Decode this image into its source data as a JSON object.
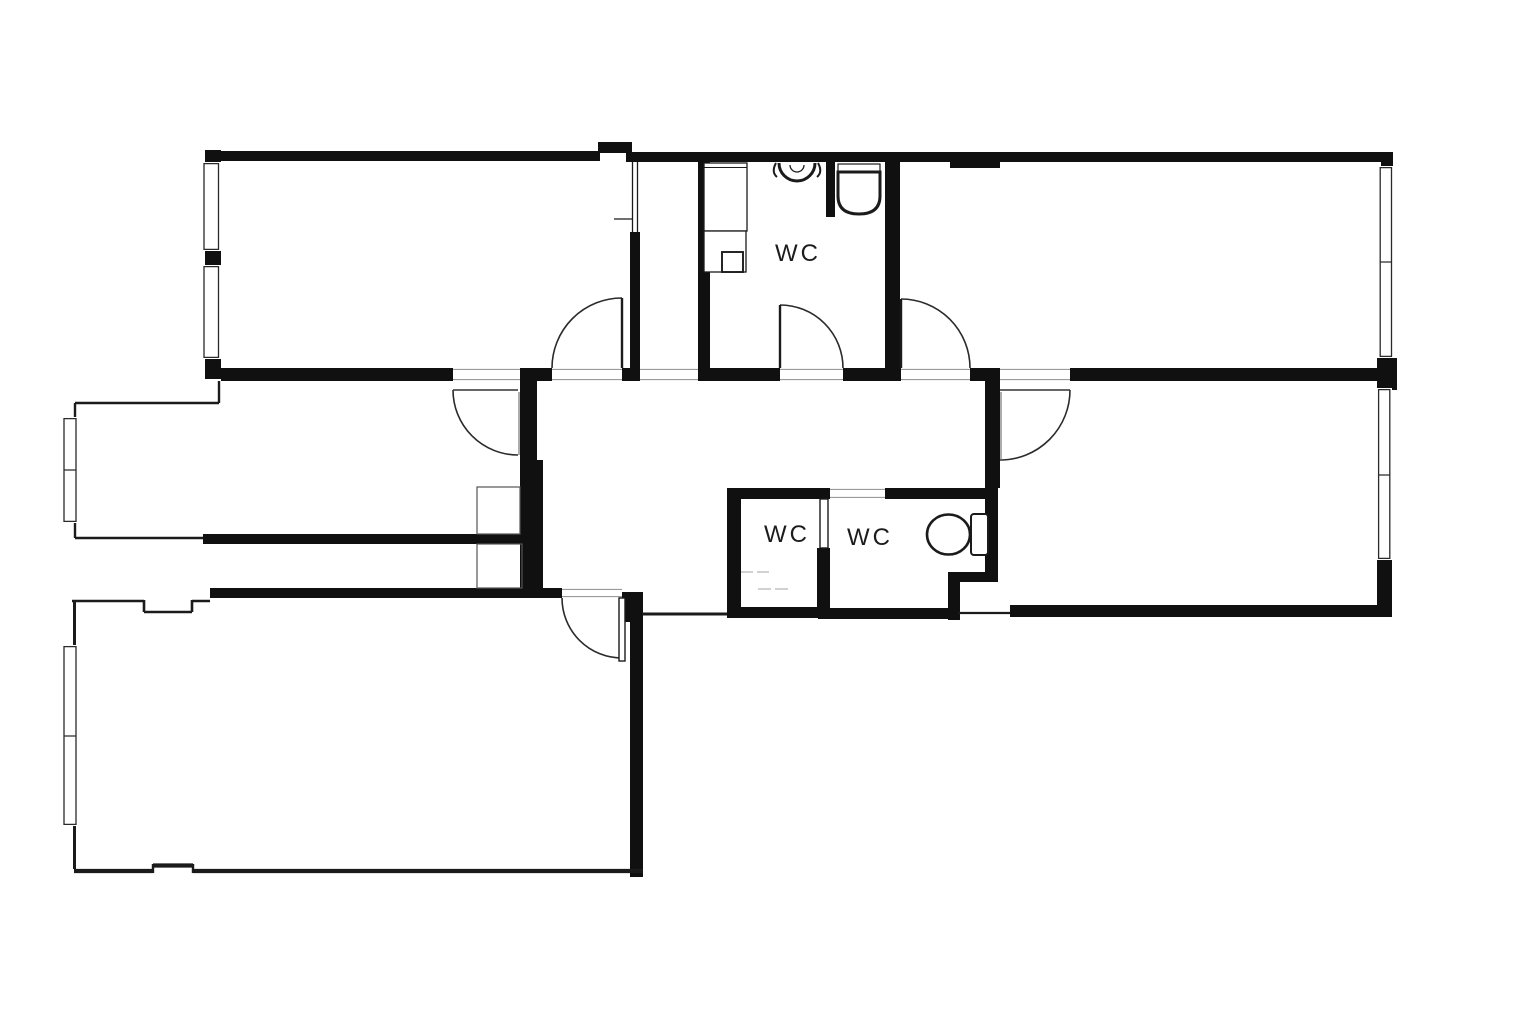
{
  "page": {
    "background": "#ffffff"
  },
  "plan": {
    "wall_color": "#101010",
    "line_color": "#1b1b1b",
    "faint_color": "#c2c2c2",
    "labels": {
      "wc_top": "WC",
      "wc_small_left": "WC",
      "wc_small_right": "WC"
    }
  }
}
